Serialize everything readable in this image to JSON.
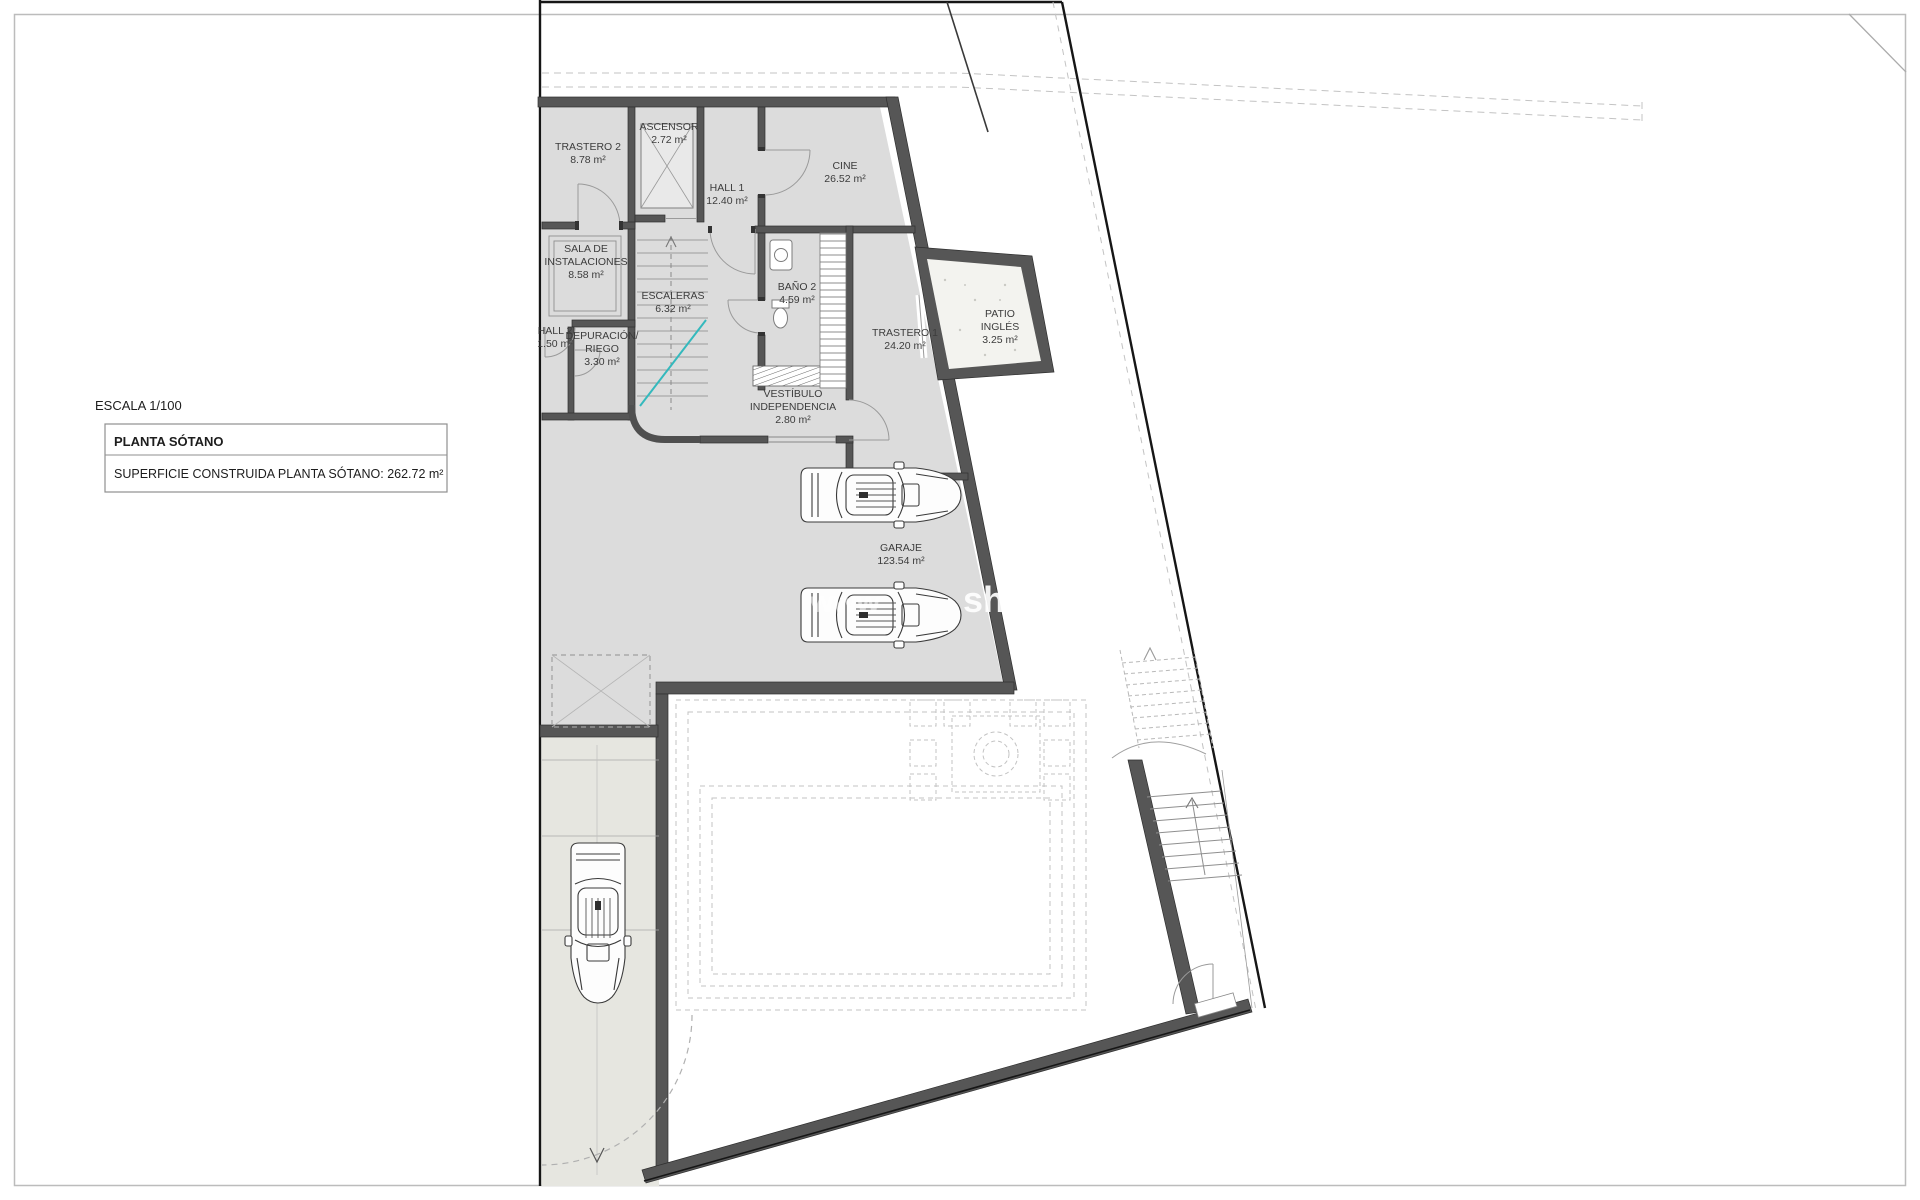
{
  "titles": {
    "scale": "ESCALA 1/100",
    "plan_title": "PLANTA SÓTANO",
    "area_line": "SUPERFICIE CONSTRUIDA PLANTA SÓTANO: 262.72 m²"
  },
  "watermark": {
    "fragment1": "www",
    "fragment2": "shab"
  },
  "colors": {
    "wall": "#565656",
    "wall_dark": "#2f2f2f",
    "interior": "#dcdcdc",
    "driveway": "#e6e6e0",
    "boundary": "#161616",
    "dashed": "#c3c3c3",
    "accent_cyan": "#34b9bd",
    "patio_fill": "#f3f3ef",
    "text": "#3c3c3c"
  },
  "rooms": [
    {
      "id": "trastero-2",
      "lines": [
        "TRASTERO 2"
      ],
      "area": "8.78 m²",
      "cx": 588,
      "cy": 150
    },
    {
      "id": "ascensor",
      "lines": [
        "ASCENSOR"
      ],
      "area": "2.72 m²",
      "cx": 669,
      "cy": 130
    },
    {
      "id": "hall-1",
      "lines": [
        "HALL 1"
      ],
      "area": "12.40 m²",
      "cx": 727,
      "cy": 191
    },
    {
      "id": "cine",
      "lines": [
        "CINE"
      ],
      "area": "26.52 m²",
      "cx": 845,
      "cy": 169
    },
    {
      "id": "sala-instalaciones",
      "lines": [
        "SALA DE",
        "INSTALACIONES"
      ],
      "area": "8.58 m²",
      "cx": 586,
      "cy": 252
    },
    {
      "id": "hall-2",
      "lines": [
        "HALL 2"
      ],
      "area": "1.50 m²",
      "cx": 555,
      "cy": 334
    },
    {
      "id": "depuracion-riego",
      "lines": [
        "DEPURACIÓN/",
        "RIEGO"
      ],
      "area": "3.30 m²",
      "cx": 602,
      "cy": 339
    },
    {
      "id": "escaleras",
      "lines": [
        "ESCALERAS"
      ],
      "area": "6.32 m²",
      "cx": 673,
      "cy": 299
    },
    {
      "id": "bano-2",
      "lines": [
        "BAÑO 2"
      ],
      "area": "4.59 m²",
      "cx": 797,
      "cy": 290
    },
    {
      "id": "trastero-1",
      "lines": [
        "TRASTERO 1"
      ],
      "area": "24.20 m²",
      "cx": 905,
      "cy": 336
    },
    {
      "id": "patio-ingles",
      "lines": [
        "PATIO",
        "INGLÉS"
      ],
      "area": "3.25 m²",
      "cx": 1000,
      "cy": 317
    },
    {
      "id": "vestibulo",
      "lines": [
        "VESTÍBULO",
        "INDEPENDENCIA"
      ],
      "area": "2.80 m²",
      "cx": 793,
      "cy": 397
    },
    {
      "id": "garaje",
      "lines": [
        "GARAJE"
      ],
      "area": "123.54 m²",
      "cx": 901,
      "cy": 551
    }
  ]
}
